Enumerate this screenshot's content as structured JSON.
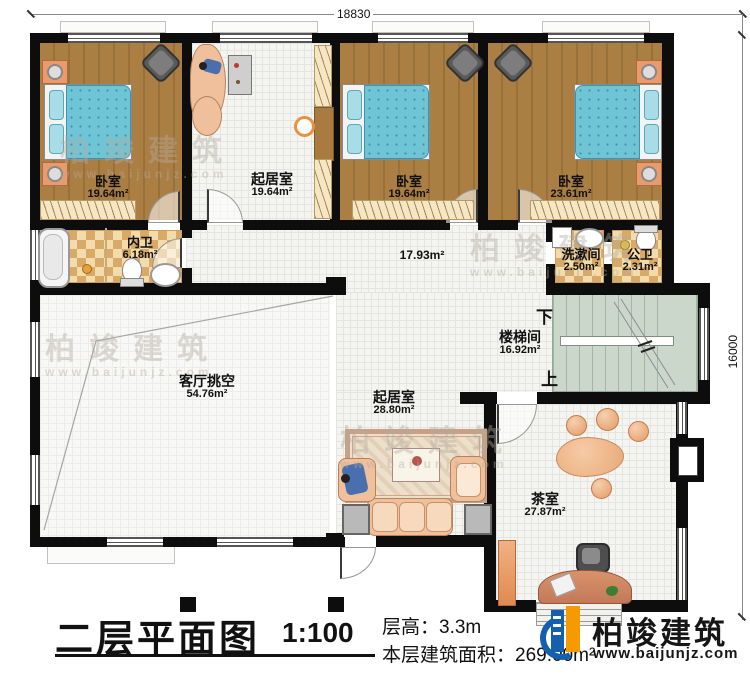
{
  "dimensions": {
    "top_width": "18830",
    "right_height": "16000"
  },
  "rooms": [
    {
      "name": "卧室",
      "area": "19.64m²"
    },
    {
      "name": "起居室",
      "area": "19.64m²"
    },
    {
      "name": "卧室",
      "area": "19.64m²"
    },
    {
      "name": "卧室",
      "area": "23.61m²"
    },
    {
      "name": "内卫",
      "area": "6.18m²"
    },
    {
      "name": "",
      "area": "17.93m²"
    },
    {
      "name": "洗漱间",
      "area": "2.50m²"
    },
    {
      "name": "公卫",
      "area": "2.31m²"
    },
    {
      "name": "楼梯间",
      "area": "16.92m²"
    },
    {
      "name": "客厅挑空",
      "area": "54.76m²"
    },
    {
      "name": "起居室",
      "area": "28.80m²"
    },
    {
      "name": "茶室",
      "area": "27.87m²"
    }
  ],
  "stairs": {
    "down": "下",
    "up": "上"
  },
  "title_block": {
    "title": "二层平面图",
    "scale": "1:100",
    "floor_height": "层高：3.3m",
    "floor_area": "本层建筑面积：269.00m²"
  },
  "brand": {
    "name": "柏竣建筑",
    "url": "www.baijunjz.com"
  },
  "watermark": {
    "text": "柏竣建筑",
    "url": "www.baijunjz.com"
  },
  "colors": {
    "wall": "#0d0d0d",
    "wood": "#a87c41",
    "stair": "#ccd7cc",
    "bed": "#6fc5d6",
    "checker": "#d9a967",
    "logo_blue": "#1460ae",
    "logo_orange": "#f59a00"
  }
}
